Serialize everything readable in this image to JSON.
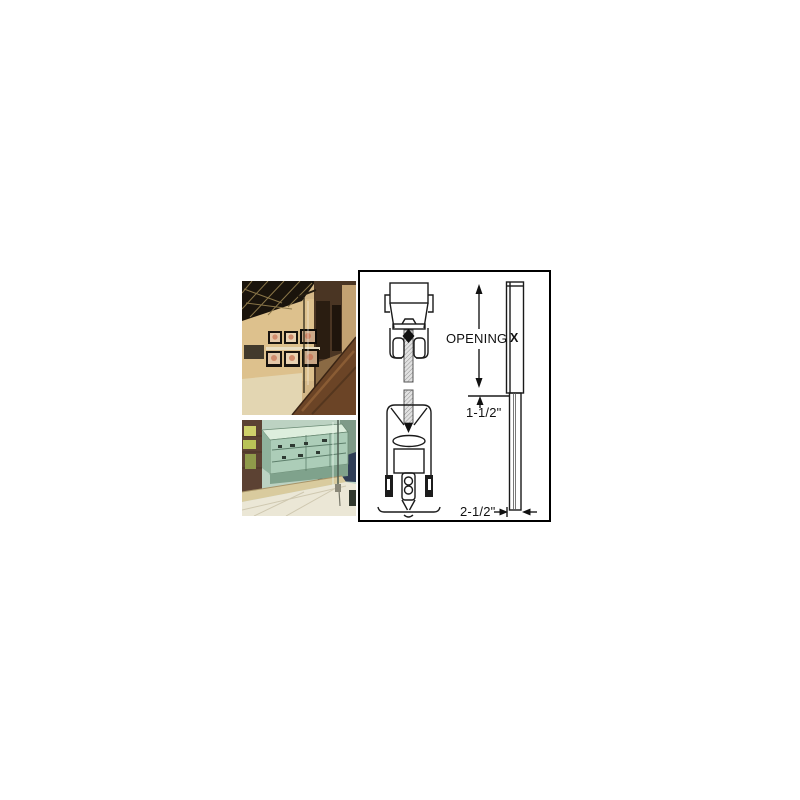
{
  "page": {
    "background_color": "#ffffff"
  },
  "collage": {
    "photos": [
      {
        "id": "storefront",
        "alt": "interior glass storefront partition with television display wall"
      },
      {
        "id": "display-case",
        "alt": "all-glass display case and glass partition on tile floor"
      }
    ]
  },
  "diagram": {
    "type": "technical-drawing",
    "border_color": "#000000",
    "line_color": "#1a1a1a",
    "labels": {
      "opening": "OPENING",
      "x_marker": "X",
      "inset_dim": "1-1/2\"",
      "width_dim": "2-1/2\""
    }
  },
  "palette": {
    "wall_tan": "#d3b787",
    "ceiling_dark": "#1a140c",
    "marble_brown": "#6b4426",
    "case_teal": "#accdb8",
    "floor_cream": "#ebe7d6",
    "carpet_navy": "#2e3c55"
  }
}
